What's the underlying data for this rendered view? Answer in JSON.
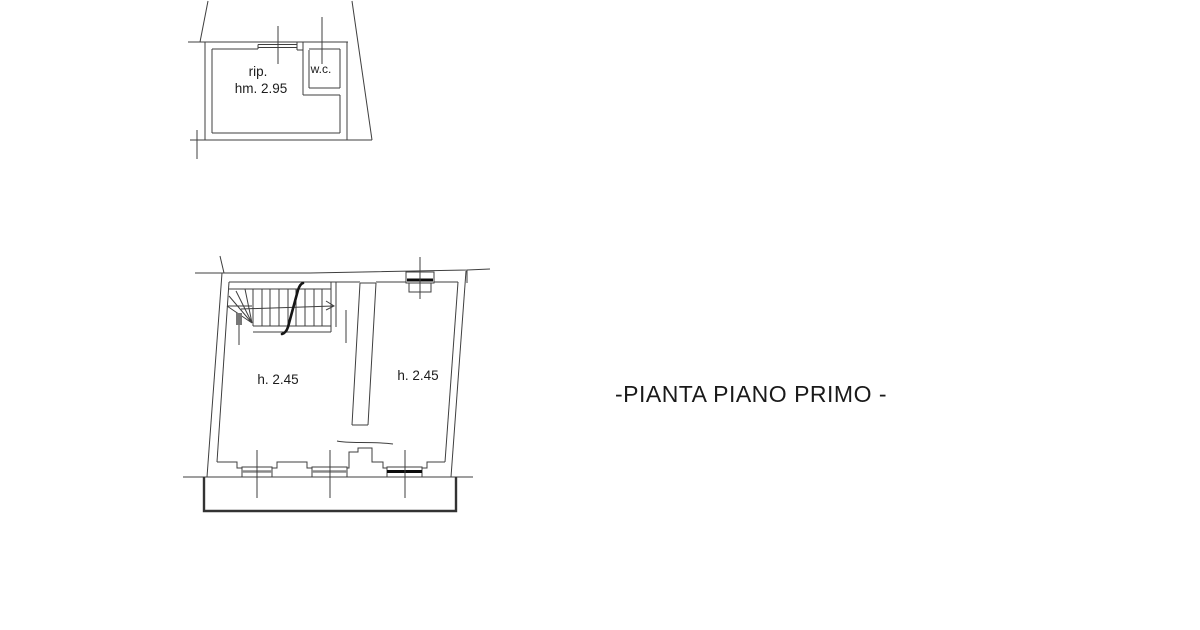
{
  "drawing": {
    "title": "-PIANTA PIANO PRIMO -",
    "upper_plan": {
      "room_label_line1": "rip.",
      "room_label_line2": "hm. 2.95",
      "wc_label": "w.c."
    },
    "lower_plan": {
      "left_room_height_label": "h. 2.45",
      "right_room_height_label": "h. 2.45"
    },
    "colors": {
      "line": "#3f3f3f",
      "emphasis": "#0c0c0c",
      "muted_band": "#8a8a8a",
      "background": "#ffffff",
      "text": "#1c1c1c"
    }
  }
}
